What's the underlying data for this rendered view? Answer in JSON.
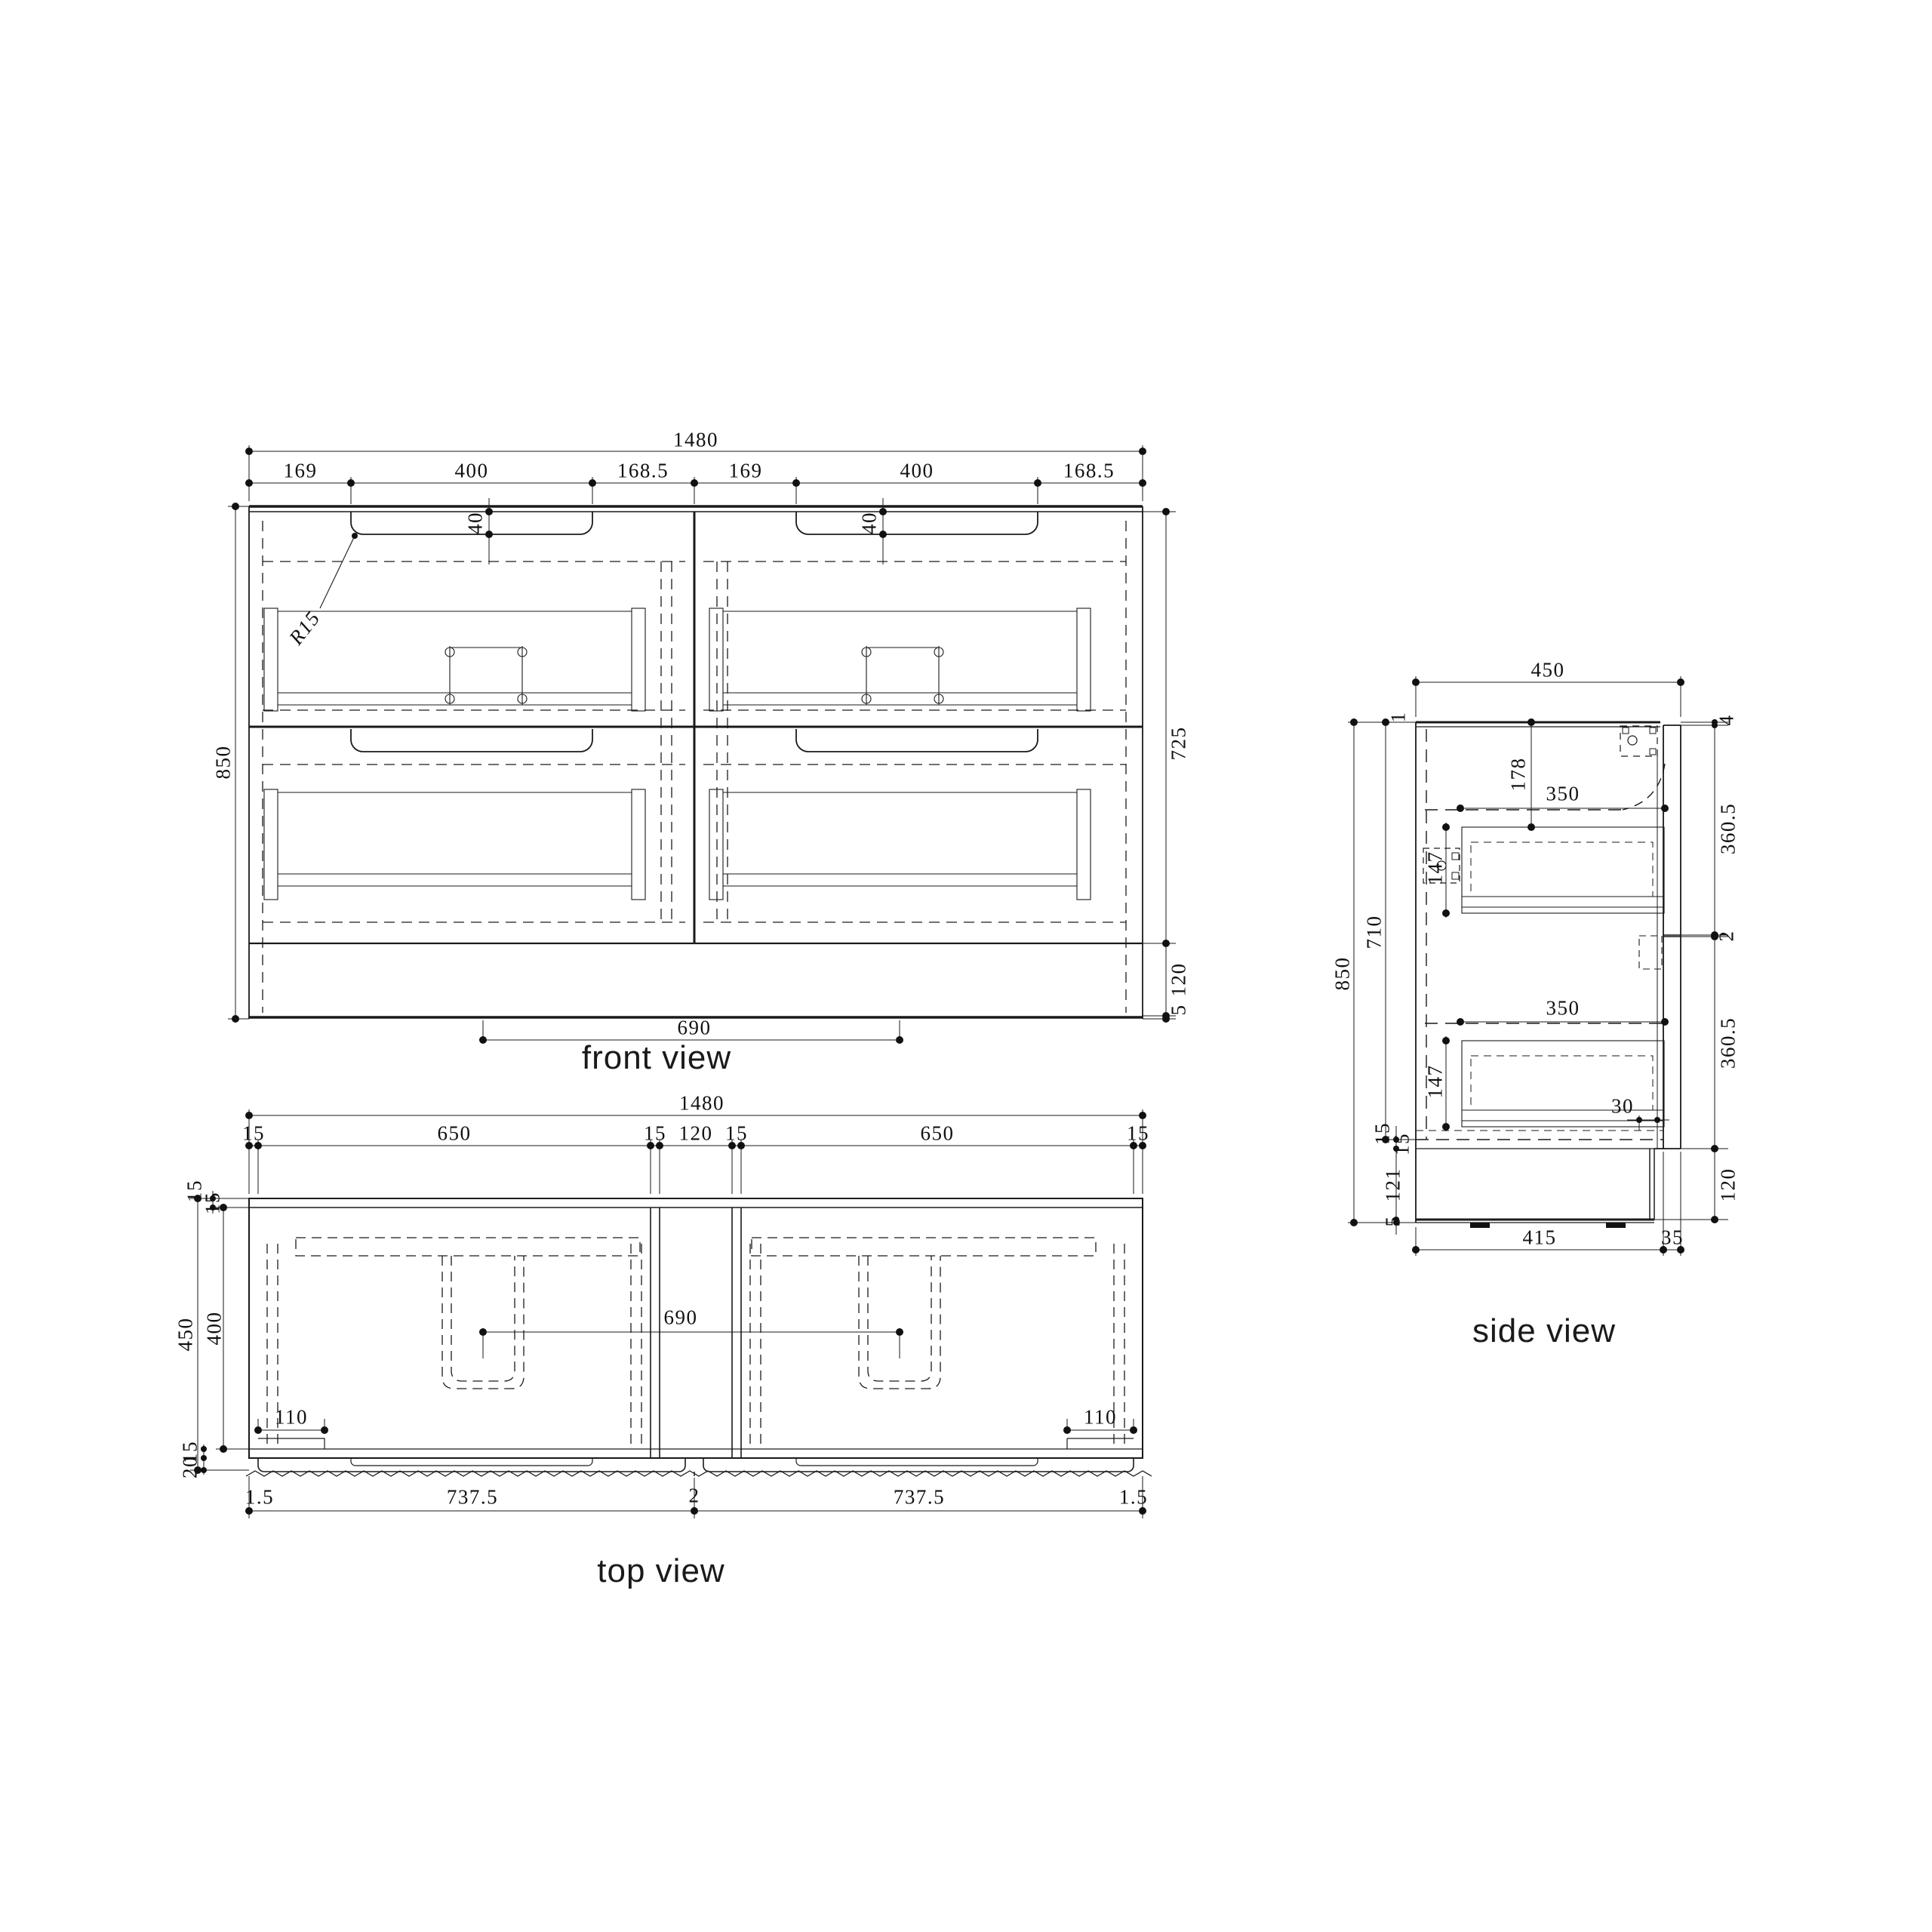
{
  "drawing": {
    "colors": {
      "ink": "#1a1a1a",
      "background": "#ffffff"
    },
    "front": {
      "label": "front view",
      "width_total": "1480",
      "seg_left_gap": "169",
      "seg_notch": "400",
      "seg_inner_gap": "168.5",
      "seg_left_gap2": "169",
      "seg_notch2": "400",
      "seg_inner_gap2": "168.5",
      "notch_depth": "40",
      "notch_depth2": "40",
      "corner_radius": "R15",
      "height_total": "850",
      "height_body": "725",
      "height_kick": "120",
      "height_base": "5",
      "drain_span": "690"
    },
    "top": {
      "label": "top view",
      "width_total": "1480",
      "seg_15a": "15",
      "seg_650a": "650",
      "seg_15b": "15",
      "seg_120": "120",
      "seg_15c": "15",
      "seg_650b": "650",
      "seg_15d": "15",
      "depth_total": "450",
      "depth_inner": "400",
      "back_15a": "15",
      "back_15b": "15",
      "front_panel_15": "15",
      "front_overhang_20": "20",
      "corner_notch_left": "110",
      "corner_notch_right": "110",
      "drain_span": "690",
      "bottom_edge_l": "1.5",
      "bottom_front_l": "737.5",
      "bottom_center": "2",
      "bottom_front_r": "737.5",
      "bottom_edge_r": "1.5"
    },
    "side": {
      "label": "side view",
      "depth_total": "450",
      "top_gap": "1",
      "height_total": "850",
      "height_carcass": "710",
      "drawer_top_offset": "178",
      "drawer_depth_1": "350",
      "drawer_height_1": "147",
      "drawer_depth_2": "350",
      "drawer_height_2": "147",
      "front_gap_top": "4",
      "front_height_1": "360.5",
      "front_gap_mid": "2",
      "front_height_2": "360.5",
      "kick_inset": "30",
      "kick_height": "120",
      "bottom_15a": "15",
      "bottom_15b": "15",
      "bottom_121": "121",
      "bottom_5": "5",
      "base_depth": "415",
      "front_thickness": "35"
    }
  }
}
